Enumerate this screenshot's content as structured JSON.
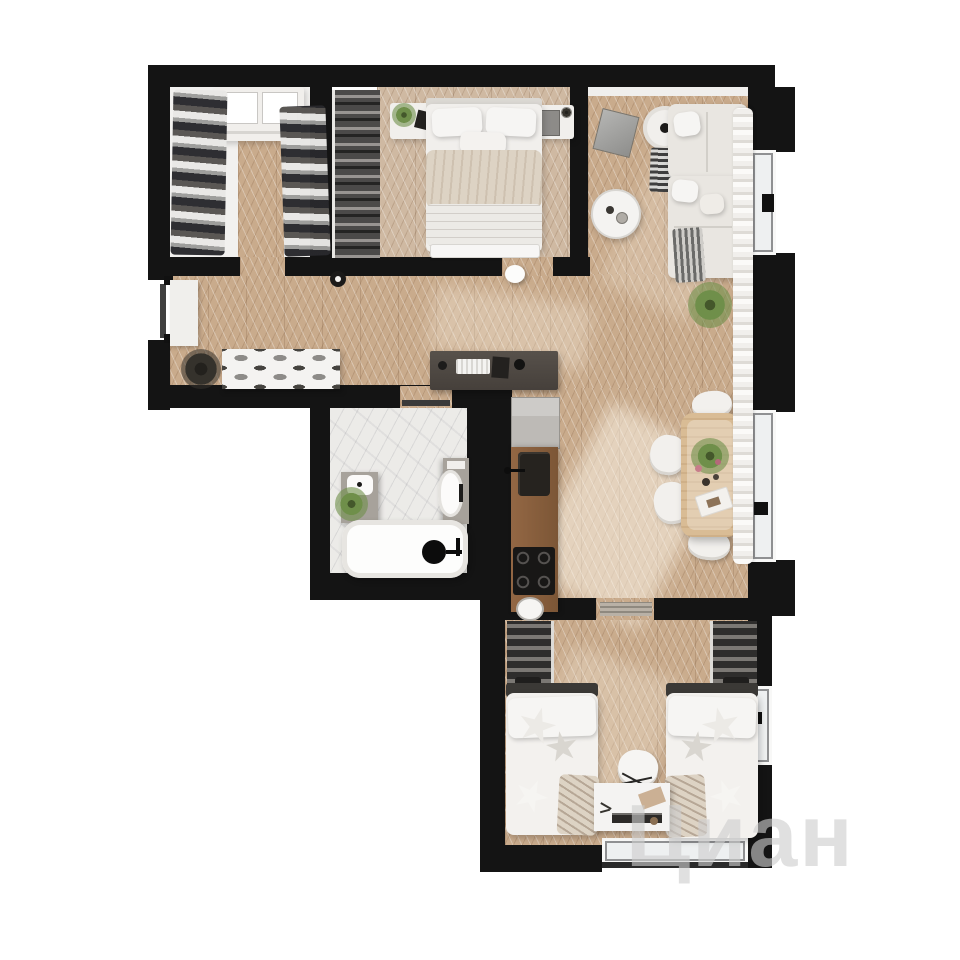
{
  "watermark": {
    "text": "Циан"
  },
  "scene": {
    "kind": "apartment-floor-plan-3d-render",
    "view": "top-down",
    "style": "black walls, herringbone oak floors, white furniture",
    "rooms": [
      {
        "name": "walk-in-closet",
        "furniture": [
          "clothes-rail-left",
          "clothes-rail-right",
          "white-dresser",
          "wood-floor-strip"
        ]
      },
      {
        "name": "bedroom",
        "furniture": [
          "open-wardrobe-strip",
          "double-bed",
          "nightstand-left-with-plant",
          "nightstand-right",
          "foot-bench"
        ]
      },
      {
        "name": "living-room",
        "furniture": [
          "corner-sofa",
          "round-armchair-with-lamp",
          "round-coffee-table",
          "tv-panel",
          "floor-plant",
          "striped-throws"
        ]
      },
      {
        "name": "hallway",
        "furniture": [
          "entry-door",
          "entry-console",
          "coat-stand",
          "shoe-cabinet",
          "ceiling-light-1",
          "ceiling-light-2"
        ]
      },
      {
        "name": "bathroom",
        "furniture": [
          "marble-floor",
          "vanity-with-sink",
          "plant",
          "toilet",
          "bathtub",
          "black-shower-head"
        ]
      },
      {
        "name": "kitchen",
        "furniture": [
          "dark-bar-counter",
          "fridge",
          "wood-counter",
          "sink",
          "cooktop-4-burner",
          "bowl"
        ]
      },
      {
        "name": "dining-area",
        "furniture": [
          "wood-table",
          "chair-top",
          "chair-bottom",
          "chair-left-1",
          "chair-left-2",
          "flower-centerpiece",
          "decor-tray"
        ]
      },
      {
        "name": "kids-bedroom",
        "furniture": [
          "wardrobe-left",
          "wardrobe-right",
          "single-bed-left",
          "single-bed-right",
          "star-pillows",
          "desk",
          "chair",
          "bottom-window"
        ]
      }
    ],
    "windows": [
      "right-window-upper",
      "right-window-middle",
      "right-window-kids",
      "kids-bottom-window"
    ]
  },
  "palette": {
    "background": "#ffffff",
    "wall": "#141414",
    "floor_wood": "#c9ab8c",
    "floor_wood_light": "#cfb9a2",
    "marble": "#ecebe8",
    "white_furniture": "#f1efec",
    "counter_dark": "#46403b",
    "kitchen_wood": "#8a5f3f",
    "fridge_gray": "#bdbab6",
    "table_wood": "#d9bc95",
    "plant_green": "#6f8f4a",
    "blanket_beige": "#ddd3c4",
    "headboard_dark": "#3b3936",
    "watermark_gray": "rgba(205,205,205,0.62)"
  }
}
